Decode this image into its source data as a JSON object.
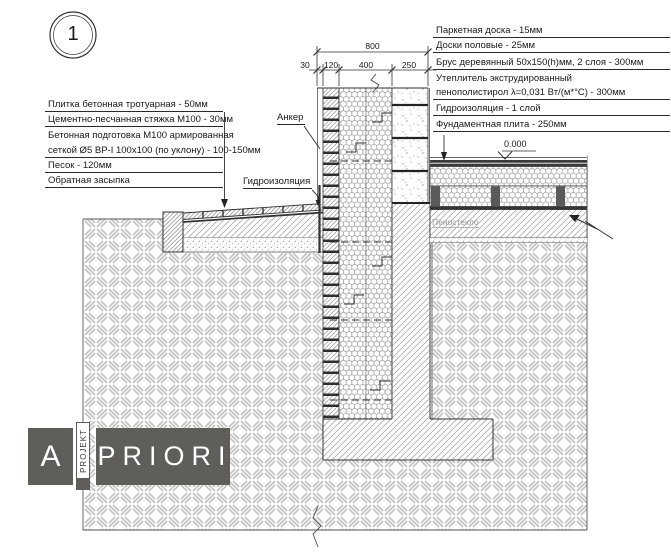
{
  "detail": {
    "number": "1"
  },
  "dimensions": {
    "overall": "800",
    "segments": [
      "30",
      "120",
      "400",
      "250"
    ]
  },
  "elevation": {
    "level": "0.000"
  },
  "callouts": {
    "anchor": "Анкер",
    "waterproofing": "Гидроизоляция",
    "foam_glass": "Пеностекло"
  },
  "left_annotations": {
    "rows": [
      {
        "text": "Плитка бетонная тротуарная - 50мм"
      },
      {
        "text": "Цементно-песчанная стяжка М100 - 30мм"
      },
      {
        "text": "Бетонная подготовка М100 армированная"
      },
      {
        "text": "сеткой Ø5 ВР-I 100x100 (по уклону) - 100-150мм"
      },
      {
        "text": "Песок - 120мм"
      },
      {
        "text": "Обратная засыпка"
      }
    ]
  },
  "right_annotations": {
    "rows": [
      {
        "text": "Паркетная доска - 15мм"
      },
      {
        "text": "Доски половые - 25мм"
      },
      {
        "text": "Брус деревянный 50x150(h)мм, 2 слоя - 300мм"
      },
      {
        "text": "Утеплитель экструдированный"
      },
      {
        "text": "пенополистирол λ=0,031 Вт/(м*°С) - 300мм"
      },
      {
        "text": "Гидроизоляция - 1 слой"
      },
      {
        "text": "Фундаментная плита - 250мм"
      }
    ]
  },
  "logo": {
    "letter": "A",
    "vertical_text": "PROJEKT",
    "main_text": "PRIORI",
    "color": "#5f5e5a"
  },
  "colors": {
    "line": "#333333",
    "hatch": "#9a9a9a",
    "ground_pattern": "#c2c2c2",
    "logo_gray": "#5f5e5a",
    "background": "#ffffff"
  }
}
